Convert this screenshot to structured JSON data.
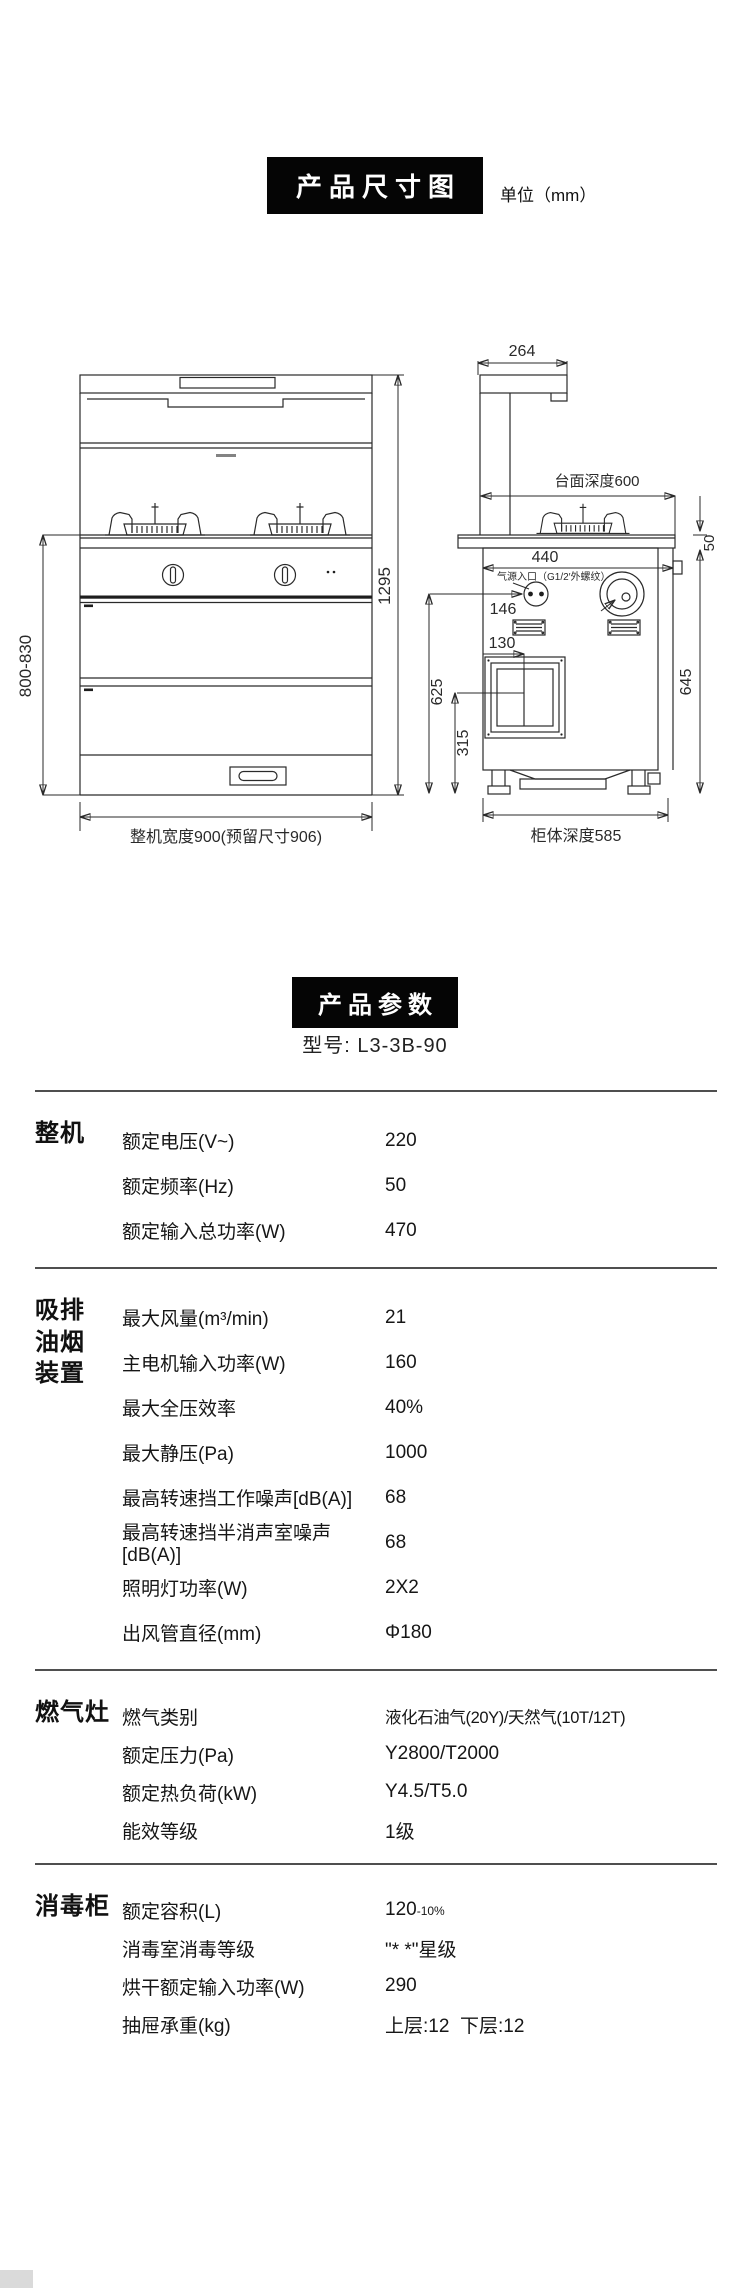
{
  "page": {
    "background": "#ffffff",
    "ink": "#1c1c1c",
    "accent": "#050505"
  },
  "diagram": {
    "title": "产品尺寸图",
    "unit": "单位（mm）",
    "labels": {
      "front_height_range": "800-830",
      "total_height": "1295",
      "overall_width": "整机宽度900(预留尺寸906)",
      "hood_top_depth": "264",
      "counter_depth": "台面深度600",
      "counter_overhang": "50",
      "back_width": "440",
      "gas_inlet": "气源入口（G1/2′外螺纹）",
      "gas_inlet_offset": "146",
      "vent_offset": "130",
      "inlet_height": "625",
      "panel_height": "315",
      "cabinet_height": "645",
      "cabinet_depth": "柜体深度585"
    }
  },
  "params": {
    "title": "产品参数",
    "model": "型号: L3-3B-90",
    "sections": [
      {
        "name": "整机",
        "rows": [
          {
            "label": "额定电压(V~)",
            "value": "220"
          },
          {
            "label": "额定频率(Hz)",
            "value": "50"
          },
          {
            "label": "额定输入总功率(W)",
            "value": "470"
          }
        ]
      },
      {
        "name": "吸排油烟装置",
        "rows": [
          {
            "label": "最大风量(m³/min)",
            "value": "21"
          },
          {
            "label": "主电机输入功率(W)",
            "value": "160"
          },
          {
            "label": "最大全压效率",
            "value": "40%"
          },
          {
            "label": "最大静压(Pa)",
            "value": "1000"
          },
          {
            "label": "最高转速挡工作噪声[dB(A)]",
            "value": "68"
          },
          {
            "label": "最高转速挡半消声室噪声[dB(A)]",
            "value": "68"
          },
          {
            "label": "照明灯功率(W)",
            "value": "2X2"
          },
          {
            "label": "出风管直径(mm)",
            "value": "Φ180"
          }
        ]
      },
      {
        "name": "燃气灶",
        "rows": [
          {
            "label": "燃气类别",
            "value": "液化石油气(20Y)/天然气(10T/12T)"
          },
          {
            "label": "额定压力(Pa)",
            "value": "Y2800/T2000"
          },
          {
            "label": "额定热负荷(kW)",
            "value": "Y4.5/T5.0"
          },
          {
            "label": "能效等级",
            "value": "1级"
          }
        ]
      },
      {
        "name": "消毒柜",
        "rows": [
          {
            "label": "额定容积(L)",
            "value": "120",
            "sub": "-10%"
          },
          {
            "label": "消毒室消毒等级",
            "value": "\"* *\"星级"
          },
          {
            "label": "烘干额定输入功率(W)",
            "value": "290"
          },
          {
            "label": "抽屉承重(kg)",
            "value": "上层:12  下层:12"
          }
        ]
      }
    ]
  }
}
